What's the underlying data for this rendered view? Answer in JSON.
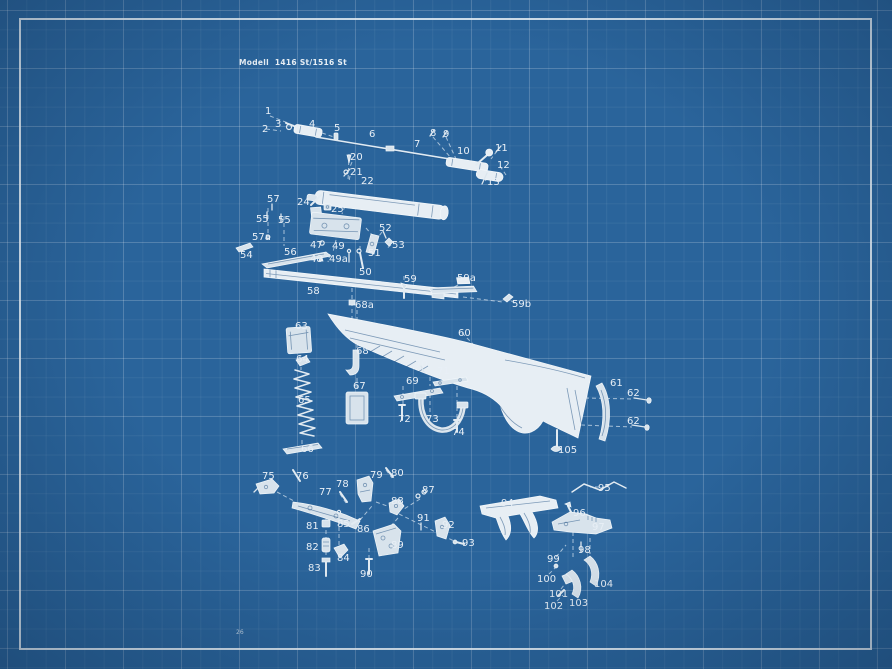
{
  "title": "Modell  1416 St/1516 St",
  "page_number": "26",
  "colors": {
    "blueprint_background": "#2a649b",
    "drawing_white": "#e8eff6",
    "frame_border": "#f0f6fa"
  },
  "diagram": {
    "labels": [
      {
        "t": "1",
        "x": 265,
        "y": 114
      },
      {
        "t": "2",
        "x": 262,
        "y": 132
      },
      {
        "t": "3",
        "x": 275,
        "y": 127
      },
      {
        "t": "4",
        "x": 309,
        "y": 127
      },
      {
        "t": "5",
        "x": 334,
        "y": 131
      },
      {
        "t": "6",
        "x": 369,
        "y": 137
      },
      {
        "t": "7",
        "x": 414,
        "y": 147
      },
      {
        "t": "8",
        "x": 430,
        "y": 136
      },
      {
        "t": "9",
        "x": 443,
        "y": 137
      },
      {
        "t": "10",
        "x": 457,
        "y": 154
      },
      {
        "t": "11",
        "x": 495,
        "y": 151
      },
      {
        "t": "12",
        "x": 497,
        "y": 168
      },
      {
        "t": "13",
        "x": 487,
        "y": 185
      },
      {
        "t": "20",
        "x": 350,
        "y": 160
      },
      {
        "t": "21",
        "x": 350,
        "y": 175
      },
      {
        "t": "22",
        "x": 361,
        "y": 184
      },
      {
        "t": "24",
        "x": 297,
        "y": 205
      },
      {
        "t": "25",
        "x": 331,
        "y": 212
      },
      {
        "t": "47",
        "x": 310,
        "y": 248
      },
      {
        "t": "48",
        "x": 310,
        "y": 262
      },
      {
        "t": "49",
        "x": 332,
        "y": 249
      },
      {
        "t": "49a",
        "x": 329,
        "y": 262
      },
      {
        "t": "50",
        "x": 359,
        "y": 275
      },
      {
        "t": "51",
        "x": 368,
        "y": 256
      },
      {
        "t": "52",
        "x": 379,
        "y": 231
      },
      {
        "t": "53",
        "x": 392,
        "y": 248
      },
      {
        "t": "54",
        "x": 240,
        "y": 258
      },
      {
        "t": "55",
        "x": 256,
        "y": 222
      },
      {
        "t": "55",
        "x": 278,
        "y": 223
      },
      {
        "t": "56",
        "x": 284,
        "y": 255
      },
      {
        "t": "57",
        "x": 267,
        "y": 202
      },
      {
        "t": "57a",
        "x": 252,
        "y": 240
      },
      {
        "t": "58",
        "x": 307,
        "y": 294
      },
      {
        "t": "59",
        "x": 404,
        "y": 282
      },
      {
        "t": "59a",
        "x": 457,
        "y": 281
      },
      {
        "t": "59b",
        "x": 512,
        "y": 307
      },
      {
        "t": "60",
        "x": 458,
        "y": 336
      },
      {
        "t": "61",
        "x": 610,
        "y": 386
      },
      {
        "t": "62",
        "x": 627,
        "y": 396
      },
      {
        "t": "62",
        "x": 627,
        "y": 424
      },
      {
        "t": "63",
        "x": 295,
        "y": 329
      },
      {
        "t": "64",
        "x": 296,
        "y": 362
      },
      {
        "t": "65",
        "x": 298,
        "y": 403
      },
      {
        "t": "66",
        "x": 301,
        "y": 452
      },
      {
        "t": "67",
        "x": 353,
        "y": 389
      },
      {
        "t": "68",
        "x": 356,
        "y": 354
      },
      {
        "t": "68a",
        "x": 355,
        "y": 308
      },
      {
        "t": "69",
        "x": 406,
        "y": 384
      },
      {
        "t": "70",
        "x": 415,
        "y": 367
      },
      {
        "t": "71",
        "x": 437,
        "y": 374
      },
      {
        "t": "72",
        "x": 398,
        "y": 422
      },
      {
        "t": "73",
        "x": 426,
        "y": 422
      },
      {
        "t": "74",
        "x": 452,
        "y": 435
      },
      {
        "t": "75",
        "x": 262,
        "y": 479
      },
      {
        "t": "76",
        "x": 296,
        "y": 479
      },
      {
        "t": "77",
        "x": 319,
        "y": 495
      },
      {
        "t": "78",
        "x": 336,
        "y": 487
      },
      {
        "t": "79",
        "x": 370,
        "y": 478
      },
      {
        "t": "80",
        "x": 391,
        "y": 476
      },
      {
        "t": "81",
        "x": 306,
        "y": 529
      },
      {
        "t": "82",
        "x": 306,
        "y": 550
      },
      {
        "t": "83",
        "x": 308,
        "y": 571
      },
      {
        "t": "84",
        "x": 337,
        "y": 561
      },
      {
        "t": "85",
        "x": 337,
        "y": 527
      },
      {
        "t": "86",
        "x": 357,
        "y": 532
      },
      {
        "t": "87",
        "x": 422,
        "y": 493
      },
      {
        "t": "88",
        "x": 391,
        "y": 504
      },
      {
        "t": "89",
        "x": 391,
        "y": 548
      },
      {
        "t": "90",
        "x": 360,
        "y": 577
      },
      {
        "t": "91",
        "x": 417,
        "y": 521
      },
      {
        "t": "92",
        "x": 442,
        "y": 528
      },
      {
        "t": "93",
        "x": 462,
        "y": 546
      },
      {
        "t": "94",
        "x": 501,
        "y": 506
      },
      {
        "t": "95",
        "x": 598,
        "y": 491
      },
      {
        "t": "96",
        "x": 573,
        "y": 516
      },
      {
        "t": "97",
        "x": 592,
        "y": 530
      },
      {
        "t": "98",
        "x": 578,
        "y": 553
      },
      {
        "t": "99",
        "x": 547,
        "y": 562
      },
      {
        "t": "100",
        "x": 537,
        "y": 582
      },
      {
        "t": "101",
        "x": 549,
        "y": 597
      },
      {
        "t": "102",
        "x": 544,
        "y": 609
      },
      {
        "t": "103",
        "x": 569,
        "y": 606
      },
      {
        "t": "104",
        "x": 594,
        "y": 587
      },
      {
        "t": "105",
        "x": 558,
        "y": 453
      }
    ]
  }
}
